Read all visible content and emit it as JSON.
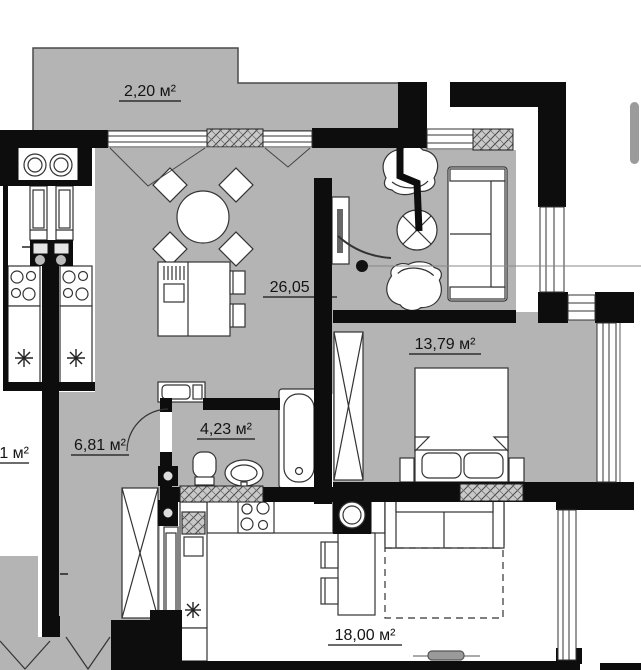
{
  "floor_plan": {
    "title": "apartment-floor-plan",
    "rooms": [
      {
        "id": "balcony",
        "area_label": "2,20 м²"
      },
      {
        "id": "kitchen_living",
        "area_label": "26,05 м²"
      },
      {
        "id": "bedroom",
        "area_label": "13,79 м²"
      },
      {
        "id": "hallway",
        "area_label": "6,81 м²"
      },
      {
        "id": "bathroom",
        "area_label": "4,23 м²"
      },
      {
        "id": "neighbor_kitchen_living",
        "area_label": "18,00 м²"
      },
      {
        "id": "neighbor_room_partial",
        "area_label": "1 м²"
      }
    ],
    "colors": {
      "floor": "#b4b4b4",
      "wall": "#0d0d0d",
      "outline": "#333333",
      "hatch_bg": "#c9c9c9",
      "scrollbar_thumb": "#9b9b9b"
    }
  }
}
